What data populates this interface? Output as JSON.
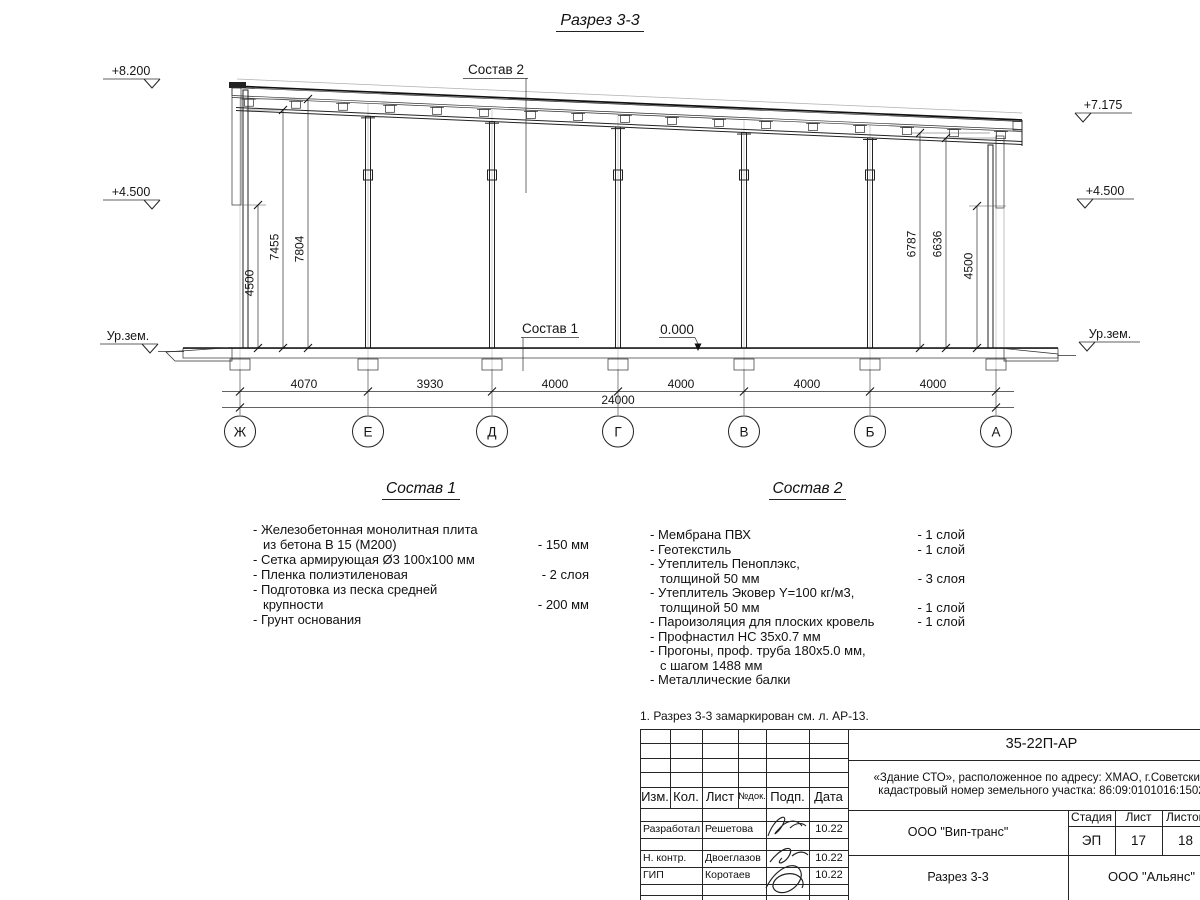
{
  "title": "Разрез 3-3",
  "section": {
    "elevations_left": [
      "+8.200",
      "+4.500",
      "Ур.зем."
    ],
    "elevations_right": [
      "+7.175",
      "+4.500",
      "Ур.зем."
    ],
    "vdims_left": [
      "4500",
      "7455",
      "7804"
    ],
    "vdims_right": [
      "6787",
      "6636",
      "4500"
    ],
    "span_dims": [
      "4070",
      "3930",
      "4000",
      "4000",
      "4000",
      "4000"
    ],
    "total_dim": "24000",
    "axes": [
      "Ж",
      "Е",
      "Д",
      "Г",
      "В",
      "Б",
      "А"
    ],
    "zero_mark": "0.000",
    "leader_roof": "Состав 2",
    "leader_floor": "Состав 1"
  },
  "composition1": {
    "heading": "Состав 1",
    "lines": [
      {
        "text": "- Железобетонная  монолитная плита",
        "value": ""
      },
      {
        "text": "из бетона В 15 (М200)",
        "value": "- 150 мм"
      },
      {
        "text": "- Сетка армирующая Ø3 100х100 мм",
        "value": ""
      },
      {
        "text": "- Пленка полиэтиленовая",
        "value": "-  2 слоя"
      },
      {
        "text": "- Подготовка из песка средней",
        "value": ""
      },
      {
        "text": "крупности",
        "value": "- 200 мм"
      },
      {
        "text": "- Грунт основания",
        "value": ""
      }
    ]
  },
  "composition2": {
    "heading": "Состав 2",
    "lines": [
      {
        "text": "- Мембрана ПВХ",
        "value": "- 1 слой"
      },
      {
        "text": "- Геотекстиль",
        "value": "- 1 слой"
      },
      {
        "text": "- Утеплитель Пеноплэкс,",
        "value": ""
      },
      {
        "text": "толщиной 50 мм",
        "value": "- 3 слоя"
      },
      {
        "text": "- Утеплитель Эковер Y=100 кг/м3,",
        "value": ""
      },
      {
        "text": "толщиной 50 мм",
        "value": "- 1 слой"
      },
      {
        "text": "- Пароизоляция для плоских кровель",
        "value": "- 1 слой"
      },
      {
        "text": "- Профнастил НС 35х0.7 мм",
        "value": ""
      },
      {
        "text": "- Прогоны, проф. труба 180х5.0 мм,",
        "value": ""
      },
      {
        "text": "с шагом 1488 мм",
        "value": ""
      },
      {
        "text": "- Металлические балки",
        "value": ""
      }
    ]
  },
  "note": "1. Разрез 3-3 замаркирован см. л. АР-13.",
  "title_block": {
    "doc_code": "35-22П-АР",
    "project_line1": "«Здание СТО», расположенное по адресу: ХМАО, г.Советский,",
    "project_line2": "кадастровый номер земельного участка: 86:09:0101016:1502",
    "header_cols": [
      "Изм.",
      "Кол.",
      "Лист",
      "№док.",
      "Подп.",
      "Дата"
    ],
    "rows": [
      {
        "role": "Разработал",
        "name": "Решетова",
        "date": "10.22"
      },
      {
        "role": "Н. контр.",
        "name": "Двоеглазов",
        "date": "10.22"
      },
      {
        "role": "ГИП",
        "name": "Коротаев",
        "date": "10.22"
      }
    ],
    "org": "ООО \"Вип-транс\"",
    "sheet_title": "Разрез 3-3",
    "org2": "ООО \"Альянс\"",
    "stage_label": "Стадия",
    "stage": "ЭП",
    "sheet_label": "Лист",
    "sheet": "17",
    "sheets_label": "Листов",
    "sheets": "18"
  }
}
